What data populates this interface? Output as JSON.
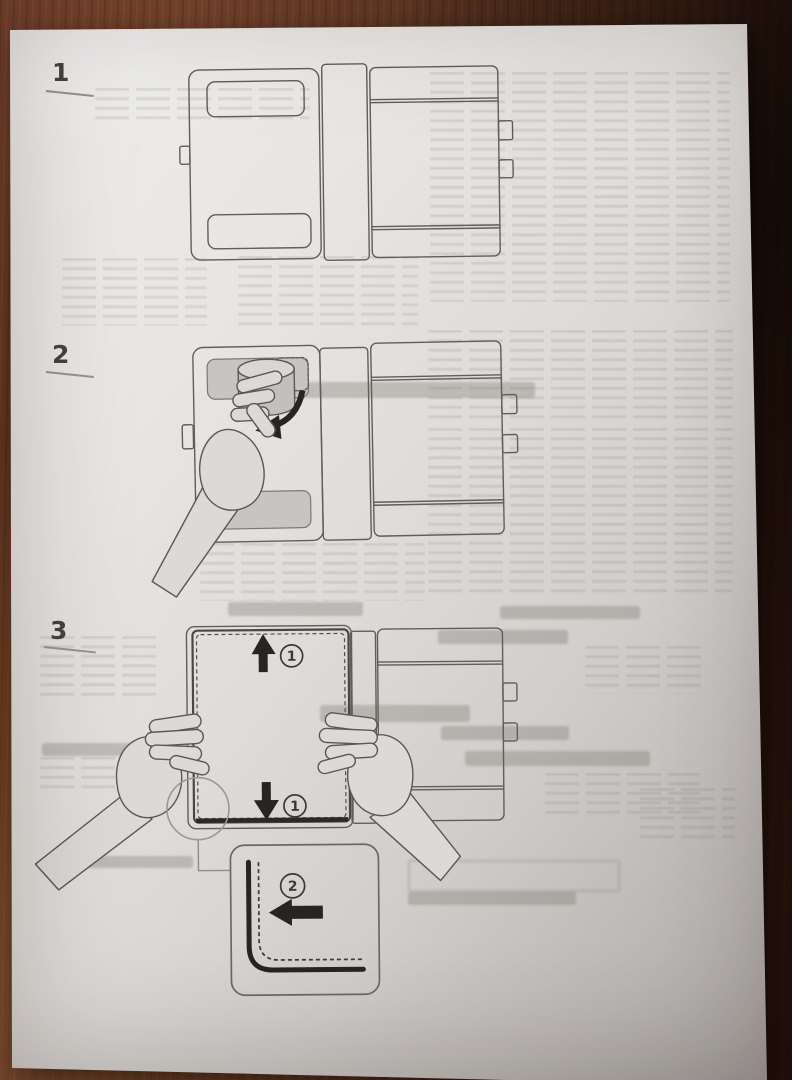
{
  "scene": {
    "subject": "Printed instruction leaflet photographed on a wooden table",
    "bleedthrough_text": "illegible mirrored show-through from reverse side of sheet",
    "colors": {
      "wood": "#6e3d27",
      "wood_dark": "#2e1712",
      "wood_light": "#8a5638",
      "paper": "#e3e1de",
      "paper_shadow": "#a5a19e",
      "line_ink": "#605d5a",
      "arrow_ink": "#262524",
      "slot_shade": "#c7c4c1"
    }
  },
  "steps": [
    {
      "number": "1"
    },
    {
      "number": "2"
    },
    {
      "number": "3"
    }
  ],
  "callouts": [
    {
      "label": "1",
      "meaning": "slide cover upward"
    },
    {
      "label": "1",
      "meaning": "slide cover downward"
    },
    {
      "label": "2",
      "meaning": "push edge into corner seam"
    }
  ]
}
